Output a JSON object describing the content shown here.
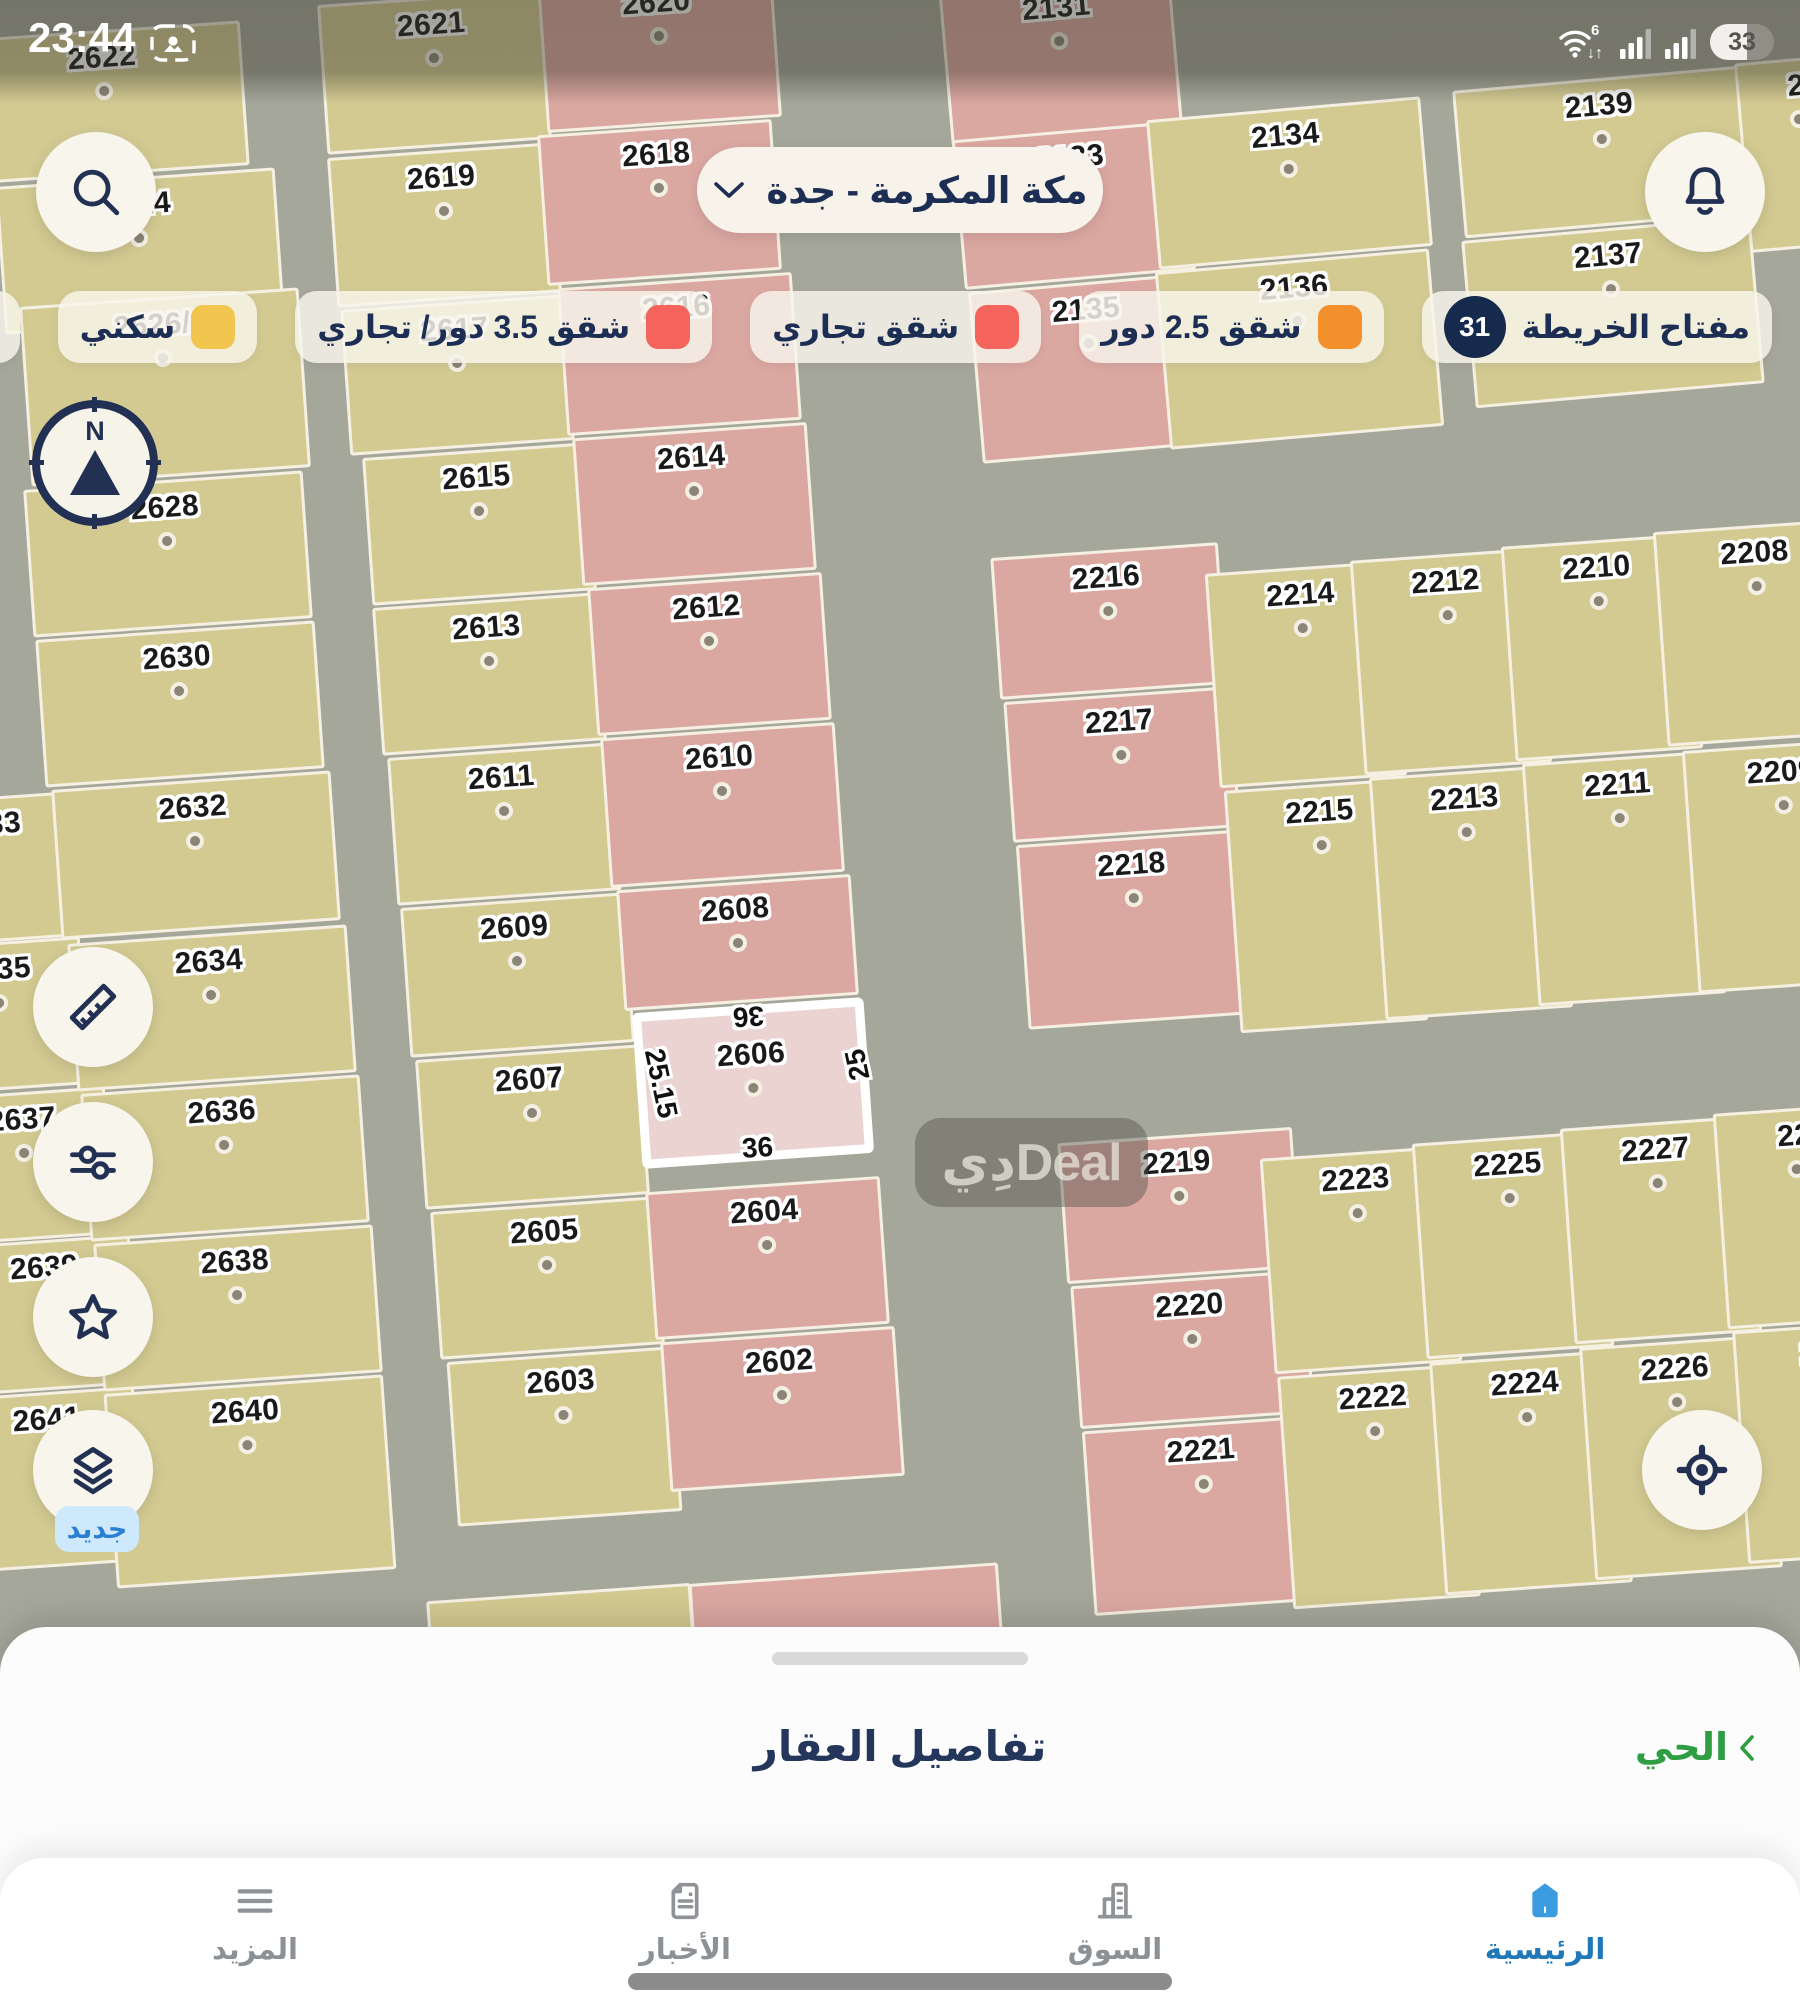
{
  "status_bar": {
    "time": "23:44",
    "battery": "33",
    "wifi_gen": "6"
  },
  "header": {
    "location": "مكة المكرمة - جدة"
  },
  "legend": {
    "key": {
      "label": "مفتاح الخريطة",
      "count": "31",
      "badge_color": "#152a4d"
    },
    "items": [
      {
        "label": "شقق 2.5 دور",
        "color": "#f2902e"
      },
      {
        "label": "شقق تجاري",
        "color": "#f4635c"
      },
      {
        "label": "شقق 3.5 دور/ تجاري",
        "color": "#f4635c"
      },
      {
        "label": "سكني",
        "color": "#f1c54e"
      },
      {
        "label": "أع",
        "color": "#c00f35"
      }
    ]
  },
  "map": {
    "colors": {
      "road": "#a6a79b",
      "residential": "#d3ca92",
      "commercial": "#dba7a1",
      "selected": "#ead3d1"
    },
    "selected": {
      "id": "2606",
      "dim_top": "36",
      "dim_bottom": "36",
      "dim_left": "25.15",
      "dim_right": "25"
    },
    "watermark": "دِيDeal",
    "new_badge": "جديد",
    "plots": [
      [
        "2633",
        -95,
        797,
        170,
        145,
        -4,
        0
      ],
      [
        "2635",
        -85,
        942,
        170,
        148,
        -4,
        0
      ],
      [
        "2637",
        -60,
        1092,
        170,
        148,
        -4,
        0
      ],
      [
        "2639",
        -40,
        1240,
        175,
        150,
        -4,
        0
      ],
      [
        "2641",
        -38,
        1392,
        178,
        175,
        -4,
        0
      ],
      [
        "2622",
        -35,
        30,
        280,
        145,
        -4,
        0
      ],
      [
        "2624",
        0,
        177,
        280,
        148,
        -4,
        0
      ],
      [
        "2626/1",
        25,
        297,
        280,
        180,
        -4,
        0
      ],
      [
        "2628",
        28,
        480,
        280,
        148,
        -4,
        0
      ],
      [
        "2630",
        40,
        630,
        280,
        148,
        -4,
        0
      ],
      [
        "2632",
        56,
        780,
        280,
        150,
        -4,
        0
      ],
      [
        "2634",
        72,
        934,
        280,
        148,
        -4,
        0
      ],
      [
        "2636",
        85,
        1084,
        280,
        148,
        -4,
        0
      ],
      [
        "2638",
        98,
        1234,
        280,
        148,
        -4,
        0
      ],
      [
        "2640",
        110,
        1384,
        280,
        195,
        -4,
        0
      ],
      [
        "2621",
        322,
        -3,
        225,
        150,
        -4,
        0
      ],
      [
        "2619",
        332,
        150,
        225,
        150,
        -4,
        0
      ],
      [
        "2617",
        345,
        302,
        225,
        146,
        -4,
        0
      ],
      [
        "2615",
        367,
        450,
        225,
        148,
        -4,
        0
      ],
      [
        "2613",
        377,
        600,
        225,
        148,
        -4,
        0
      ],
      [
        "2611",
        392,
        750,
        225,
        148,
        -4,
        0
      ],
      [
        "2609",
        405,
        900,
        225,
        150,
        -4,
        0
      ],
      [
        "2607",
        420,
        1052,
        225,
        150,
        -4,
        0
      ],
      [
        "2605",
        435,
        1204,
        225,
        148,
        -4,
        0
      ],
      [
        "2603",
        452,
        1354,
        225,
        165,
        -4,
        0
      ],
      [
        "2620",
        542,
        -25,
        235,
        150,
        -4,
        1
      ],
      [
        "2618",
        542,
        127,
        235,
        151,
        -4,
        1
      ],
      [
        "2616",
        562,
        280,
        235,
        148,
        -4,
        1
      ],
      [
        "2614",
        577,
        430,
        235,
        148,
        -4,
        1
      ],
      [
        "2612",
        592,
        580,
        235,
        148,
        -4,
        1
      ],
      [
        "2610",
        605,
        730,
        235,
        150,
        -4,
        1
      ],
      [
        "2608",
        620,
        882,
        235,
        121,
        -4,
        1
      ],
      [
        "2606",
        637,
        1005,
        232,
        156,
        -4,
        2
      ],
      [
        "2604",
        650,
        1184,
        235,
        148,
        -4,
        1
      ],
      [
        "2602",
        665,
        1334,
        235,
        150,
        -4,
        1
      ],
      [
        "2131",
        945,
        -20,
        232,
        163,
        -5,
        1
      ],
      [
        "2133",
        958,
        130,
        232,
        150,
        -5,
        1
      ],
      [
        "2135",
        975,
        282,
        232,
        172,
        -5,
        1
      ],
      [
        "2134",
        1152,
        108,
        275,
        150,
        -5,
        0
      ],
      [
        "2136",
        1162,
        260,
        275,
        178,
        -5,
        0
      ],
      [
        "2139",
        1458,
        78,
        290,
        148,
        -5,
        0
      ],
      [
        "2137",
        1468,
        228,
        290,
        168,
        -5,
        0
      ],
      [
        "2",
        1742,
        58,
        120,
        190,
        -5,
        0
      ],
      [
        "2216",
        995,
        550,
        228,
        142,
        -4,
        1
      ],
      [
        "2217",
        1008,
        694,
        228,
        141,
        -4,
        1
      ],
      [
        "2218",
        1022,
        837,
        228,
        185,
        -4,
        1
      ],
      [
        "2214",
        1212,
        567,
        188,
        215,
        -4,
        0
      ],
      [
        "2212",
        1357,
        554,
        188,
        215,
        -4,
        0
      ],
      [
        "2210",
        1508,
        540,
        188,
        215,
        -4,
        0
      ],
      [
        "2208",
        1660,
        525,
        200,
        215,
        -4,
        0
      ],
      [
        "2215",
        1232,
        784,
        188,
        243,
        -4,
        0
      ],
      [
        "2213",
        1377,
        771,
        188,
        243,
        -4,
        0
      ],
      [
        "2211",
        1530,
        757,
        188,
        243,
        -4,
        0
      ],
      [
        "2209",
        1690,
        744,
        195,
        243,
        -4,
        0
      ],
      [
        "2219",
        1062,
        1135,
        235,
        141,
        -4,
        1
      ],
      [
        "2220",
        1075,
        1278,
        235,
        143,
        -4,
        1
      ],
      [
        "2221",
        1088,
        1423,
        235,
        185,
        -4,
        1
      ],
      [
        "2223",
        1267,
        1152,
        188,
        216,
        -4,
        0
      ],
      [
        "2225",
        1419,
        1137,
        188,
        216,
        -4,
        0
      ],
      [
        "2227",
        1567,
        1122,
        188,
        216,
        -4,
        0
      ],
      [
        "22",
        1720,
        1108,
        160,
        216,
        -4,
        0
      ],
      [
        "2222",
        1285,
        1370,
        188,
        233,
        -4,
        0
      ],
      [
        "2224",
        1437,
        1356,
        188,
        233,
        -4,
        0
      ],
      [
        "2226",
        1587,
        1341,
        188,
        233,
        -4,
        0
      ],
      [
        "2",
        1740,
        1326,
        150,
        233,
        -4,
        0
      ],
      [
        "",
        693,
        1573,
        310,
        140,
        -4,
        1
      ],
      [
        "",
        430,
        1592,
        265,
        120,
        -4,
        0
      ]
    ]
  },
  "sheet": {
    "title": "تفاصيل العقار",
    "district_link": "الحي"
  },
  "nav": {
    "items": [
      {
        "label": "المزيد"
      },
      {
        "label": "الأخبار"
      },
      {
        "label": "السوق"
      },
      {
        "label": "الرئيسية"
      }
    ]
  }
}
